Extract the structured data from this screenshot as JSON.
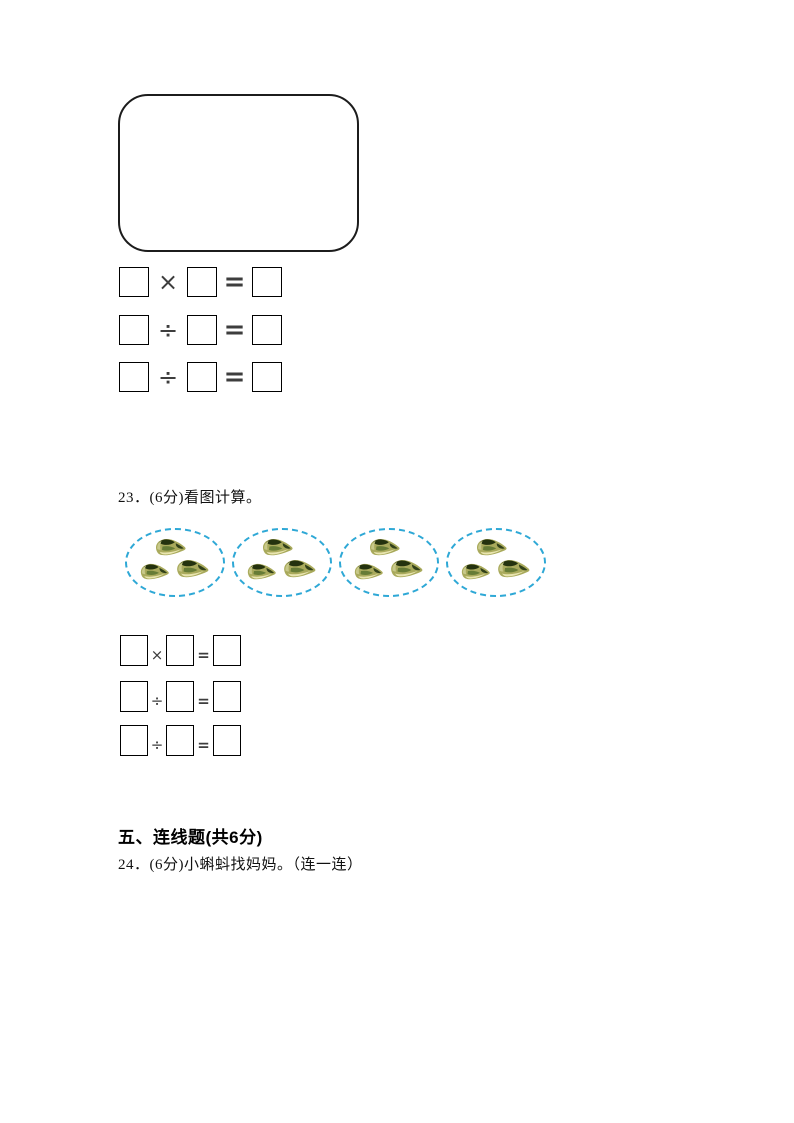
{
  "page": {
    "width": 794,
    "height": 1123,
    "background": "#ffffff"
  },
  "colors": {
    "box_border": "#000000",
    "shape_border": "#1c1c1c",
    "operator": "#3d3d3d",
    "ellipse_dash": "#2ea8d6",
    "shell_body": "#a9aa5c",
    "shell_dark": "#24320e",
    "shell_mid": "#667c36",
    "shell_light": "#e9e5b0"
  },
  "top_section": {
    "shape": "empty rounded rectangle",
    "equations": {
      "rows": [
        {
          "op": "×",
          "eq": "="
        },
        {
          "op": "÷",
          "eq": "="
        },
        {
          "op": "÷",
          "eq": "="
        }
      ]
    }
  },
  "question23": {
    "label": "23．(6分)看图计算。",
    "picture": {
      "group_count": 4,
      "shells_per_group": 3,
      "item": "green-conch-shell"
    },
    "equations": {
      "rows": [
        {
          "op": "×",
          "eq": "="
        },
        {
          "op": "÷",
          "eq": "="
        },
        {
          "op": "÷",
          "eq": "="
        }
      ]
    }
  },
  "section_five": {
    "title": "五、连线题(共6分)"
  },
  "question24": {
    "label": "24．(6分)小蝌蚪找妈妈。（连一连）"
  }
}
